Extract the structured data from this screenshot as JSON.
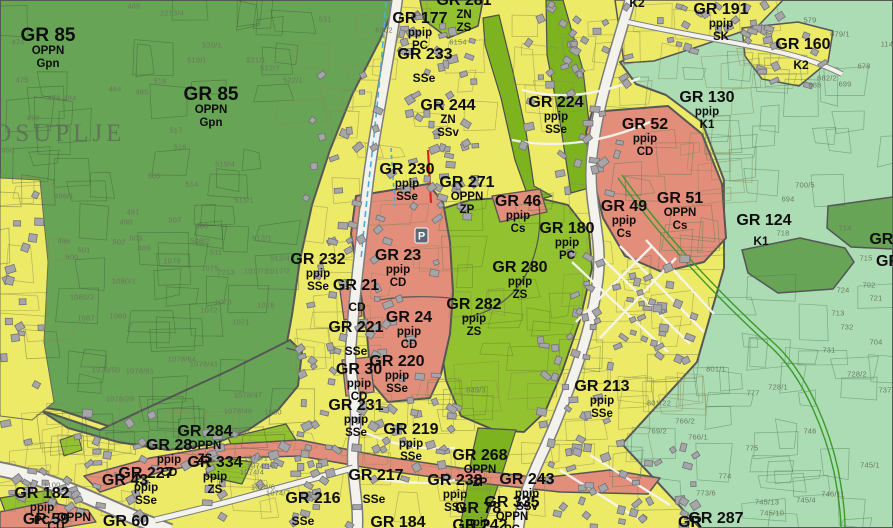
{
  "map": {
    "city_label": "GROSUPLJE",
    "parking_icon_label": "P"
  },
  "legend_colors": {
    "forest_green": "#68a456",
    "agricultural_mint": "#abdcb4",
    "residential_yellow": "#ecea67",
    "center_salmon": "#e28e7b",
    "recreation_green_zs": "#92c22f",
    "road_white": "#f3f2ec",
    "boundary_gray": "#565656",
    "stream_blue": "#45aee2",
    "marker_red": "#e02020",
    "building_gray": "#a6a6a9"
  },
  "zone_labels": [
    {
      "name": "GR 85",
      "sub": [
        "OPPN",
        "Gpn"
      ],
      "x": 48,
      "y": 36,
      "size": "lg"
    },
    {
      "name": "GR 85",
      "sub": [
        "OPPN",
        "Gpn"
      ],
      "x": 211,
      "y": 95,
      "size": "lg"
    },
    {
      "name": "GR 177",
      "sub": [
        "ppip",
        "PC"
      ],
      "x": 420,
      "y": 21
    },
    {
      "name": "GR 281",
      "sub": [
        "ZN",
        "ZS"
      ],
      "x": 464,
      "y": 3
    },
    {
      "name": "GR 233",
      "sub": [],
      "x": 425,
      "y": 57
    },
    {
      "name": "SSe",
      "sub": [],
      "kind": "sub",
      "x": 424,
      "y": 78
    },
    {
      "name": "GR 244",
      "sub": [
        "ZN",
        "SSv"
      ],
      "x": 448,
      "y": 108
    },
    {
      "name": "GR 224",
      "sub": [
        "ppip",
        "SSe"
      ],
      "x": 556,
      "y": 105
    },
    {
      "name": "GR 191",
      "sub": [
        "ppip",
        "SK"
      ],
      "x": 721,
      "y": 12
    },
    {
      "name": "GR 160",
      "sub": [],
      "x": 803,
      "y": 47
    },
    {
      "name": "K2",
      "sub": [],
      "kind": "sub",
      "x": 801,
      "y": 65
    },
    {
      "name": "K2",
      "sub": [],
      "kind": "sub",
      "x": 637,
      "y": 3
    },
    {
      "name": "GR 130",
      "sub": [
        "ppip",
        "K1"
      ],
      "x": 707,
      "y": 100
    },
    {
      "name": "GR 52",
      "sub": [
        "ppip",
        "CD"
      ],
      "x": 645,
      "y": 127
    },
    {
      "name": "GR 124",
      "sub": [],
      "x": 764,
      "y": 223
    },
    {
      "name": "K1",
      "sub": [],
      "kind": "sub",
      "x": 761,
      "y": 241
    },
    {
      "name": "GR 230",
      "sub": [
        "ppip",
        "SSe"
      ],
      "x": 407,
      "y": 172
    },
    {
      "name": "GR 271",
      "sub": [
        "OPPN",
        "ZP"
      ],
      "x": 467,
      "y": 185
    },
    {
      "name": "GR 46",
      "sub": [
        "ppip",
        "Cs"
      ],
      "x": 518,
      "y": 204
    },
    {
      "name": "GR 180",
      "sub": [
        "ppip",
        "PC"
      ],
      "x": 567,
      "y": 231
    },
    {
      "name": "GR 49",
      "sub": [
        "ppip",
        "Cs"
      ],
      "x": 624,
      "y": 209
    },
    {
      "name": "GR 51",
      "sub": [
        "OPPN",
        "Cs"
      ],
      "x": 680,
      "y": 201
    },
    {
      "name": "GR 232",
      "sub": [
        "ppip",
        "SSe"
      ],
      "x": 318,
      "y": 262
    },
    {
      "name": "GR 23",
      "sub": [
        "ppip",
        "CD"
      ],
      "x": 398,
      "y": 258
    },
    {
      "name": "GR 21",
      "sub": [],
      "x": 356,
      "y": 288
    },
    {
      "name": "CD",
      "sub": [],
      "kind": "sub",
      "x": 357,
      "y": 307
    },
    {
      "name": "GR 221",
      "sub": [],
      "x": 356,
      "y": 330
    },
    {
      "name": "SSe",
      "sub": [],
      "kind": "sub",
      "x": 356,
      "y": 351
    },
    {
      "name": "GR 24",
      "sub": [
        "ppip",
        "CD"
      ],
      "x": 409,
      "y": 320
    },
    {
      "name": "GR 282",
      "sub": [
        "ppip",
        "ZS"
      ],
      "x": 474,
      "y": 307
    },
    {
      "name": "GR 280",
      "sub": [
        "ppip",
        "ZS"
      ],
      "x": 520,
      "y": 270
    },
    {
      "name": "GR 213",
      "sub": [
        "ppip",
        "SSe"
      ],
      "x": 602,
      "y": 389
    },
    {
      "name": "GR 30",
      "sub": [
        "ppip",
        "CD"
      ],
      "x": 359,
      "y": 372
    },
    {
      "name": "GR 220",
      "sub": [
        "ppip",
        "SSe"
      ],
      "x": 397,
      "y": 364
    },
    {
      "name": "GR 231",
      "sub": [
        "ppip",
        "SSe"
      ],
      "x": 356,
      "y": 408
    },
    {
      "name": "GR 219",
      "sub": [
        "ppip",
        "SSe"
      ],
      "x": 411,
      "y": 432
    },
    {
      "name": "GR 217",
      "sub": [],
      "x": 376,
      "y": 478
    },
    {
      "name": "SSe",
      "sub": [],
      "kind": "sub",
      "x": 374,
      "y": 499
    },
    {
      "name": "GR 216",
      "sub": [],
      "x": 313,
      "y": 501
    },
    {
      "name": "SSe",
      "sub": [],
      "kind": "sub",
      "x": 303,
      "y": 521
    },
    {
      "name": "GR 268",
      "sub": [
        "OPPN",
        "ZP"
      ],
      "x": 480,
      "y": 458
    },
    {
      "name": "GR 238",
      "sub": [
        "ppip",
        "SSv"
      ],
      "x": 455,
      "y": 483
    },
    {
      "name": "GR 243",
      "sub": [
        "ppip",
        "SSv"
      ],
      "x": 527,
      "y": 482
    },
    {
      "name": "GR 335",
      "sub": [
        "OPPN",
        "PC"
      ],
      "x": 512,
      "y": 505
    },
    {
      "name": "GR 78",
      "sub": [
        "ppip"
      ],
      "x": 478,
      "y": 511
    },
    {
      "name": "GR 284",
      "sub": [
        "OPPN",
        "ZS"
      ],
      "x": 205,
      "y": 434
    },
    {
      "name": "GR 28",
      "sub": [
        "ppip",
        "CD"
      ],
      "x": 169,
      "y": 448
    },
    {
      "name": "GR 334",
      "sub": [
        "ppip",
        "ZS"
      ],
      "x": 215,
      "y": 465
    },
    {
      "name": "GR 227",
      "sub": [
        "ppip",
        "SSe"
      ],
      "x": 146,
      "y": 476
    },
    {
      "name": "GR 43",
      "sub": [],
      "x": 125,
      "y": 483
    },
    {
      "name": "GR 182",
      "sub": [
        "ppip",
        "PC"
      ],
      "x": 42,
      "y": 496
    },
    {
      "name": "GR 59",
      "sub": [],
      "x": 46,
      "y": 522
    },
    {
      "name": "OPPN",
      "sub": [],
      "kind": "sub",
      "x": 74,
      "y": 517
    },
    {
      "name": "CU",
      "sub": [],
      "kind": "sub",
      "x": 56,
      "y": 526
    },
    {
      "name": "GR 60",
      "sub": [],
      "x": 126,
      "y": 524
    },
    {
      "name": "GR 184",
      "sub": [],
      "x": 398,
      "y": 525
    },
    {
      "name": "GR 242",
      "sub": [],
      "x": 480,
      "y": 528
    },
    {
      "name": "GR 287",
      "sub": [],
      "x": 716,
      "y": 521
    },
    {
      "name": "GR",
      "sub": [],
      "x": 690,
      "y": 525
    },
    {
      "name": "GR 1",
      "sub": [],
      "x": 888,
      "y": 242
    },
    {
      "name": "GR",
      "sub": [],
      "x": 888,
      "y": 264
    }
  ],
  "parcel_numbers": [
    {
      "t": "474",
      "x": 18,
      "y": 42
    },
    {
      "t": "475",
      "x": 22,
      "y": 80
    },
    {
      "t": "478",
      "x": 54,
      "y": 98
    },
    {
      "t": "478",
      "x": 33,
      "y": 118
    },
    {
      "t": "484",
      "x": 70,
      "y": 98
    },
    {
      "t": "464",
      "x": 115,
      "y": 89
    },
    {
      "t": "485",
      "x": 142,
      "y": 92
    },
    {
      "t": "518",
      "x": 160,
      "y": 81
    },
    {
      "t": "519/1",
      "x": 197,
      "y": 60
    },
    {
      "t": "2213/4",
      "x": 172,
      "y": 13
    },
    {
      "t": "488",
      "x": 134,
      "y": 6
    },
    {
      "t": "520/1",
      "x": 212,
      "y": 45
    },
    {
      "t": "521/1",
      "x": 256,
      "y": 60
    },
    {
      "t": "522/7",
      "x": 270,
      "y": 68
    },
    {
      "t": "522/1",
      "x": 293,
      "y": 80
    },
    {
      "t": "517",
      "x": 176,
      "y": 130
    },
    {
      "t": "516",
      "x": 180,
      "y": 147
    },
    {
      "t": "519/4",
      "x": 225,
      "y": 164
    },
    {
      "t": "505",
      "x": 154,
      "y": 176
    },
    {
      "t": "531",
      "x": 325,
      "y": 19
    },
    {
      "t": "466/1",
      "x": 64,
      "y": 196
    },
    {
      "t": "514",
      "x": 192,
      "y": 184
    },
    {
      "t": "491",
      "x": 133,
      "y": 212
    },
    {
      "t": "490",
      "x": 126,
      "y": 222
    },
    {
      "t": "507",
      "x": 175,
      "y": 220
    },
    {
      "t": "506",
      "x": 202,
      "y": 226
    },
    {
      "t": "508/2",
      "x": 200,
      "y": 241
    },
    {
      "t": "511",
      "x": 216,
      "y": 252
    },
    {
      "t": "513/1",
      "x": 244,
      "y": 200
    },
    {
      "t": "512/1",
      "x": 262,
      "y": 238
    },
    {
      "t": "512/4",
      "x": 280,
      "y": 258
    },
    {
      "t": "486",
      "x": 64,
      "y": 241
    },
    {
      "t": "500",
      "x": 72,
      "y": 257
    },
    {
      "t": "501",
      "x": 84,
      "y": 250
    },
    {
      "t": "502",
      "x": 119,
      "y": 242
    },
    {
      "t": "503",
      "x": 136,
      "y": 238
    },
    {
      "t": "489",
      "x": 144,
      "y": 248
    },
    {
      "t": "1079",
      "x": 172,
      "y": 261
    },
    {
      "t": "1075",
      "x": 210,
      "y": 268
    },
    {
      "t": "2213",
      "x": 226,
      "y": 272
    },
    {
      "t": "1017/1",
      "x": 256,
      "y": 271
    },
    {
      "t": "1017/2",
      "x": 278,
      "y": 271
    },
    {
      "t": "1080/1",
      "x": 124,
      "y": 281
    },
    {
      "t": "1080/2",
      "x": 82,
      "y": 297
    },
    {
      "t": "1087",
      "x": 86,
      "y": 318
    },
    {
      "t": "1080",
      "x": 118,
      "y": 316
    },
    {
      "t": "1073",
      "x": 223,
      "y": 302
    },
    {
      "t": "1072",
      "x": 209,
      "y": 310
    },
    {
      "t": "1071",
      "x": 241,
      "y": 322
    },
    {
      "t": "1018",
      "x": 266,
      "y": 305
    },
    {
      "t": "1078/64",
      "x": 182,
      "y": 359
    },
    {
      "t": "1078/61",
      "x": 140,
      "y": 371
    },
    {
      "t": "1078/41",
      "x": 204,
      "y": 364
    },
    {
      "t": "1078/28",
      "x": 120,
      "y": 399
    },
    {
      "t": "1078/50",
      "x": 106,
      "y": 370
    },
    {
      "t": "1030",
      "x": 273,
      "y": 412
    },
    {
      "t": "1078/47",
      "x": 248,
      "y": 395
    },
    {
      "t": "1078/46",
      "x": 238,
      "y": 411
    },
    {
      "t": "1078/8",
      "x": 237,
      "y": 431
    },
    {
      "t": "450",
      "x": 8,
      "y": 150
    },
    {
      "t": "579",
      "x": 810,
      "y": 20
    },
    {
      "t": "679/1",
      "x": 840,
      "y": 34
    },
    {
      "t": "678",
      "x": 864,
      "y": 66
    },
    {
      "t": "699",
      "x": 845,
      "y": 84
    },
    {
      "t": "686",
      "x": 815,
      "y": 85
    },
    {
      "t": "682/2",
      "x": 827,
      "y": 78
    },
    {
      "t": "114",
      "x": 887,
      "y": 44
    },
    {
      "t": "700/5",
      "x": 805,
      "y": 185
    },
    {
      "t": "694",
      "x": 788,
      "y": 199
    },
    {
      "t": "714",
      "x": 845,
      "y": 228
    },
    {
      "t": "715",
      "x": 866,
      "y": 258
    },
    {
      "t": "718",
      "x": 783,
      "y": 233
    },
    {
      "t": "724",
      "x": 843,
      "y": 290
    },
    {
      "t": "721",
      "x": 876,
      "y": 298
    },
    {
      "t": "713",
      "x": 838,
      "y": 313
    },
    {
      "t": "732",
      "x": 847,
      "y": 327
    },
    {
      "t": "731",
      "x": 829,
      "y": 350
    },
    {
      "t": "702",
      "x": 869,
      "y": 285
    },
    {
      "t": "704",
      "x": 876,
      "y": 342
    },
    {
      "t": "746",
      "x": 810,
      "y": 431
    },
    {
      "t": "745/1",
      "x": 870,
      "y": 465
    },
    {
      "t": "775",
      "x": 752,
      "y": 448
    },
    {
      "t": "774",
      "x": 725,
      "y": 476
    },
    {
      "t": "773/6",
      "x": 706,
      "y": 493
    },
    {
      "t": "745/13",
      "x": 767,
      "y": 502
    },
    {
      "t": "745/10",
      "x": 772,
      "y": 513
    },
    {
      "t": "745/4",
      "x": 806,
      "y": 500
    },
    {
      "t": "746/11",
      "x": 833,
      "y": 494
    },
    {
      "t": "728/2",
      "x": 857,
      "y": 374
    },
    {
      "t": "728/1",
      "x": 778,
      "y": 387
    },
    {
      "t": "777",
      "x": 753,
      "y": 393
    },
    {
      "t": "737",
      "x": 885,
      "y": 390
    },
    {
      "t": "801/1",
      "x": 716,
      "y": 369
    },
    {
      "t": "801/22",
      "x": 659,
      "y": 403
    },
    {
      "t": "766/2",
      "x": 685,
      "y": 421
    },
    {
      "t": "766/1",
      "x": 698,
      "y": 437
    },
    {
      "t": "769/2",
      "x": 657,
      "y": 431
    },
    {
      "t": "6154",
      "x": 458,
      "y": 42
    },
    {
      "t": "1074/1",
      "x": 256,
      "y": 458
    },
    {
      "t": "1074/16",
      "x": 261,
      "y": 466
    },
    {
      "t": "1074/4",
      "x": 252,
      "y": 472
    },
    {
      "t": "1074/6",
      "x": 263,
      "y": 487
    },
    {
      "t": "1074/7",
      "x": 278,
      "y": 493
    },
    {
      "t": "849/3",
      "x": 476,
      "y": 390
    },
    {
      "t": "6302",
      "x": 384,
      "y": 30
    },
    {
      "t": "1100",
      "x": 52,
      "y": 485
    }
  ]
}
